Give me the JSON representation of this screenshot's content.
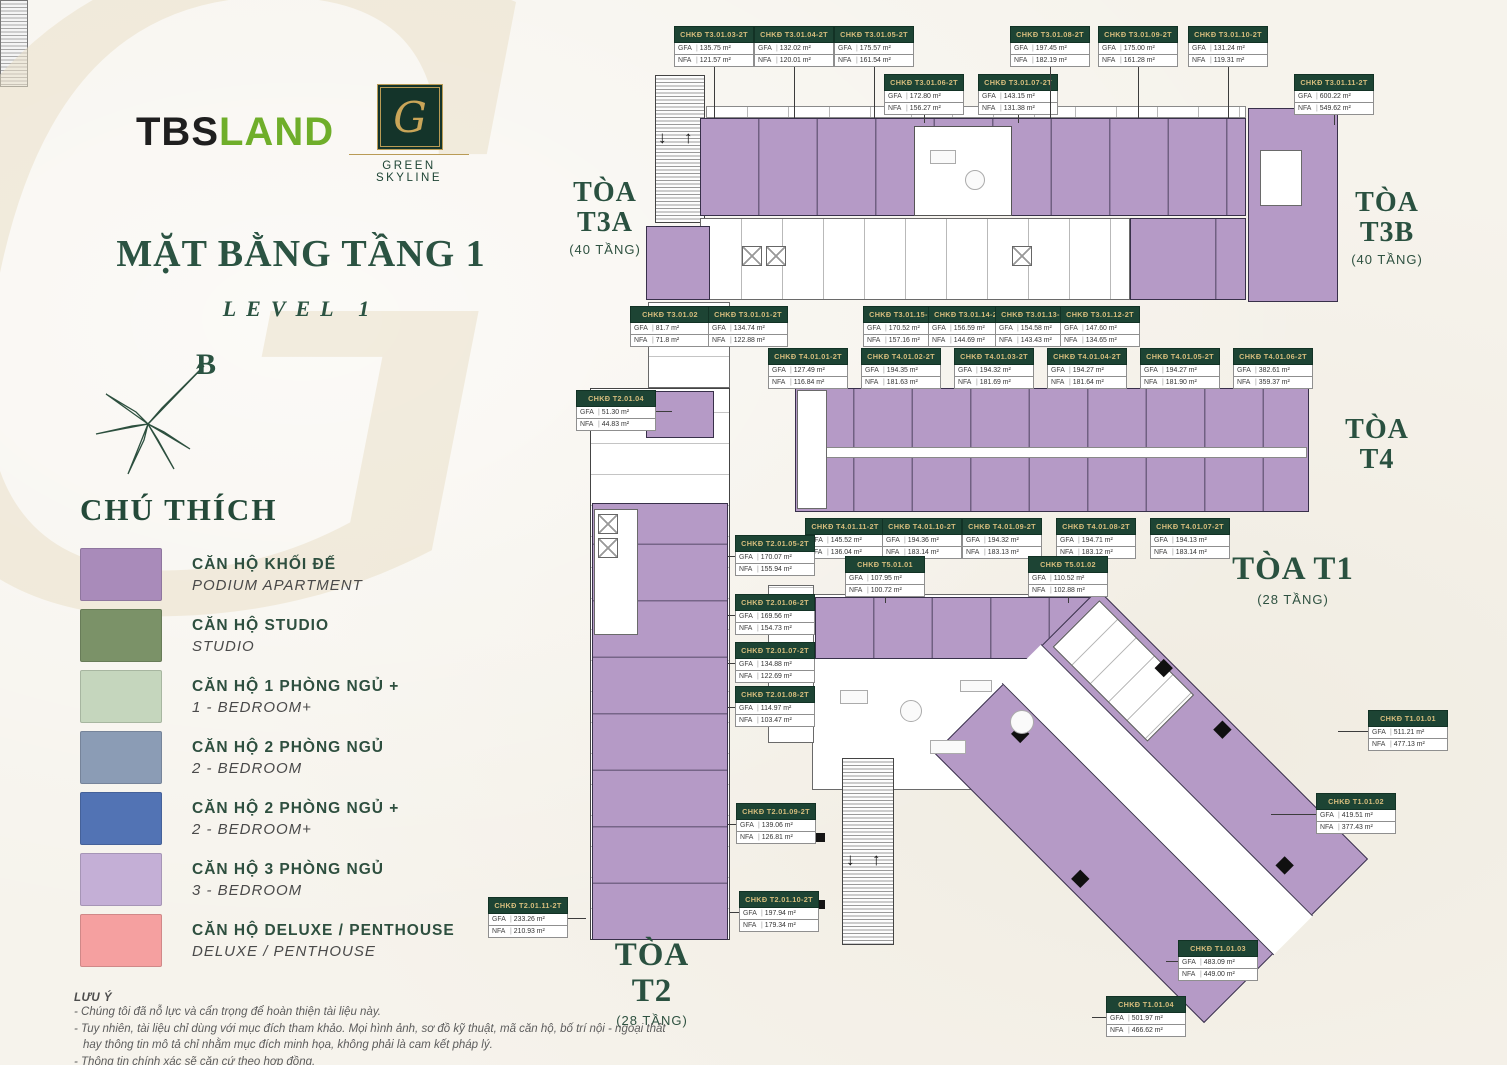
{
  "header": {
    "watermark": "G",
    "tbs_part1": "TBS",
    "tbs_part2": "LAND",
    "gs_monogram": "G",
    "gs_name": "GREEN SKYLINE",
    "title": "MẶT BẰNG TẦNG 1",
    "subtitle": "LEVEL 1",
    "compass": "B"
  },
  "icons": {
    "down_arrow": "↓",
    "up_arrow": "↑"
  },
  "labels": {
    "gfa": "GFA",
    "nfa": "NFA",
    "divider": "|"
  },
  "unit_label_prefix": "CHKĐ",
  "legend": {
    "title": "CHÚ THÍCH",
    "items": [
      {
        "vi": "CĂN HỘ KHỐI ĐẾ",
        "en": "PODIUM APARTMENT",
        "color": "#a98bba"
      },
      {
        "vi": "CĂN HỘ STUDIO",
        "en": "STUDIO",
        "color": "#7b9268"
      },
      {
        "vi": "CĂN HỘ 1 PHÒNG NGỦ +",
        "en": "1 - BEDROOM+",
        "color": "#c5d6bd"
      },
      {
        "vi": "CĂN HỘ 2 PHÒNG NGỦ",
        "en": "2 - BEDROOM",
        "color": "#8b9cb5"
      },
      {
        "vi": "CĂN HỘ 2 PHÒNG NGỦ +",
        "en": "2 - BEDROOM+",
        "color": "#5273b4"
      },
      {
        "vi": "CĂN HỘ 3 PHÒNG NGỦ",
        "en": "3 - BEDROOM",
        "color": "#c4afd6"
      },
      {
        "vi": "CĂN HỘ DELUXE / PENTHOUSE",
        "en": "DELUXE / PENTHOUSE",
        "color": "#f5a0a0"
      }
    ]
  },
  "buildings": [
    {
      "lines": [
        "TÒA",
        "T3A"
      ],
      "floors": "(40 TẦNG)",
      "x": 560,
      "y": 178,
      "w": 90,
      "size": 28
    },
    {
      "lines": [
        "TÒA",
        "T3B"
      ],
      "floors": "(40 TẦNG)",
      "x": 1342,
      "y": 188,
      "w": 90,
      "size": 28
    },
    {
      "lines": [
        "TÒA",
        "T4"
      ],
      "floors": "",
      "x": 1332,
      "y": 415,
      "w": 90,
      "size": 28
    },
    {
      "lines": [
        "TÒA T1"
      ],
      "floors": "(28 TẦNG)",
      "x": 1228,
      "y": 552,
      "w": 130,
      "size": 33
    },
    {
      "lines": [
        "TÒA T2"
      ],
      "floors": "(28 TẦNG)",
      "x": 592,
      "y": 938,
      "w": 120,
      "size": 33
    }
  ],
  "units": [
    {
      "id": "T3.01.03-2T",
      "gfa": "135.75 m²",
      "nfa": "121.57 m²",
      "x": 674,
      "y": 26,
      "ld": "down",
      "ll": 51
    },
    {
      "id": "T3.01.04-2T",
      "gfa": "132.02 m²",
      "nfa": "120.01 m²",
      "x": 754,
      "y": 26,
      "ld": "down",
      "ll": 51
    },
    {
      "id": "T3.01.05-2T",
      "gfa": "175.57 m²",
      "nfa": "161.54 m²",
      "x": 834,
      "y": 26,
      "ld": "down",
      "ll": 51
    },
    {
      "id": "T3.01.06-2T",
      "gfa": "172.80 m²",
      "nfa": "156.27 m²",
      "x": 884,
      "y": 74,
      "ld": "down",
      "ll": 8
    },
    {
      "id": "T3.01.07-2T",
      "gfa": "143.15 m²",
      "nfa": "131.38 m²",
      "x": 978,
      "y": 74,
      "ld": "down",
      "ll": 8
    },
    {
      "id": "T3.01.08-2T",
      "gfa": "197.45 m²",
      "nfa": "182.19 m²",
      "x": 1010,
      "y": 26,
      "ld": "down",
      "ll": 51
    },
    {
      "id": "T3.01.09-2T",
      "gfa": "175.00 m²",
      "nfa": "161.28 m²",
      "x": 1098,
      "y": 26,
      "ld": "down",
      "ll": 51
    },
    {
      "id": "T3.01.10-2T",
      "gfa": "131.24 m²",
      "nfa": "119.31 m²",
      "x": 1188,
      "y": 26,
      "ld": "down",
      "ll": 51
    },
    {
      "id": "T3.01.11-2T",
      "gfa": "600.22 m²",
      "nfa": "549.62 m²",
      "x": 1294,
      "y": 74,
      "ld": "down",
      "ll": 10
    },
    {
      "id": "T3.01.02",
      "gfa": "81.7 m²",
      "nfa": "71.8 m²",
      "x": 630,
      "y": 306
    },
    {
      "id": "T3.01.01-2T",
      "gfa": "134.74 m²",
      "nfa": "122.88 m²",
      "x": 708,
      "y": 306
    },
    {
      "id": "T3.01.15-2T",
      "gfa": "170.52 m²",
      "nfa": "157.16 m²",
      "x": 863,
      "y": 306
    },
    {
      "id": "T3.01.14-2T",
      "gfa": "156.59 m²",
      "nfa": "144.69 m²",
      "x": 928,
      "y": 306
    },
    {
      "id": "T3.01.13-2T",
      "gfa": "154.58 m²",
      "nfa": "143.43 m²",
      "x": 995,
      "y": 306
    },
    {
      "id": "T3.01.12-2T",
      "gfa": "147.60 m²",
      "nfa": "134.65 m²",
      "x": 1060,
      "y": 306
    },
    {
      "id": "T4.01.01-2T",
      "gfa": "127.49 m²",
      "nfa": "116.84 m²",
      "x": 768,
      "y": 348
    },
    {
      "id": "T4.01.02-2T",
      "gfa": "194.35 m²",
      "nfa": "181.63 m²",
      "x": 861,
      "y": 348
    },
    {
      "id": "T4.01.03-2T",
      "gfa": "194.32 m²",
      "nfa": "181.69 m²",
      "x": 954,
      "y": 348
    },
    {
      "id": "T4.01.04-2T",
      "gfa": "194.27 m²",
      "nfa": "181.64 m²",
      "x": 1047,
      "y": 348
    },
    {
      "id": "T4.01.05-2T",
      "gfa": "194.27 m²",
      "nfa": "181.90 m²",
      "x": 1140,
      "y": 348
    },
    {
      "id": "T4.01.06-2T",
      "gfa": "382.61 m²",
      "nfa": "359.37 m²",
      "x": 1233,
      "y": 348
    },
    {
      "id": "T4.01.11-2T",
      "gfa": "145.52 m²",
      "nfa": "136.04 m²",
      "x": 805,
      "y": 518
    },
    {
      "id": "T4.01.10-2T",
      "gfa": "194.36 m²",
      "nfa": "183.14 m²",
      "x": 882,
      "y": 518
    },
    {
      "id": "T4.01.09-2T",
      "gfa": "194.32 m²",
      "nfa": "183.13 m²",
      "x": 962,
      "y": 518
    },
    {
      "id": "T4.01.08-2T",
      "gfa": "194.71 m²",
      "nfa": "183.12 m²",
      "x": 1056,
      "y": 518
    },
    {
      "id": "T4.01.07-2T",
      "gfa": "194.13 m²",
      "nfa": "183.14 m²",
      "x": 1150,
      "y": 518
    },
    {
      "id": "T2.01.04",
      "gfa": "51.30 m²",
      "nfa": "44.83 m²",
      "x": 576,
      "y": 390,
      "ld": "right",
      "ll": 16
    },
    {
      "id": "T2.01.05-2T",
      "gfa": "170.07 m²",
      "nfa": "155.94 m²",
      "x": 735,
      "y": 535,
      "ld": "left",
      "ll": 7
    },
    {
      "id": "T2.01.06-2T",
      "gfa": "169.56 m²",
      "nfa": "154.73 m²",
      "x": 735,
      "y": 594,
      "ld": "left",
      "ll": 7
    },
    {
      "id": "T2.01.07-2T",
      "gfa": "134.88 m²",
      "nfa": "122.69 m²",
      "x": 735,
      "y": 642,
      "ld": "left",
      "ll": 7
    },
    {
      "id": "T2.01.08-2T",
      "gfa": "114.97 m²",
      "nfa": "103.47 m²",
      "x": 735,
      "y": 686,
      "ld": "left",
      "ll": 7
    },
    {
      "id": "T2.01.09-2T",
      "gfa": "139.06 m²",
      "nfa": "126.81 m²",
      "x": 736,
      "y": 803,
      "ld": "left",
      "ll": 8
    },
    {
      "id": "T2.01.10-2T",
      "gfa": "197.94 m²",
      "nfa": "179.34 m²",
      "x": 739,
      "y": 891,
      "ld": "left",
      "ll": 10
    },
    {
      "id": "T2.01.11-2T",
      "gfa": "233.26 m²",
      "nfa": "210.93 m²",
      "x": 488,
      "y": 897,
      "ld": "right",
      "ll": 18
    },
    {
      "id": "T5.01.01",
      "gfa": "107.95 m²",
      "nfa": "100.72 m²",
      "x": 845,
      "y": 556,
      "ld": "down",
      "ll": 6
    },
    {
      "id": "T5.01.02",
      "gfa": "110.52 m²",
      "nfa": "102.88 m²",
      "x": 1028,
      "y": 556,
      "ld": "down",
      "ll": 6
    },
    {
      "id": "T1.01.01",
      "gfa": "511.21 m²",
      "nfa": "477.13 m²",
      "x": 1368,
      "y": 710,
      "ld": "left",
      "ll": 30
    },
    {
      "id": "T1.01.02",
      "gfa": "419.51 m²",
      "nfa": "377.43 m²",
      "x": 1316,
      "y": 793,
      "ld": "left",
      "ll": 45
    },
    {
      "id": "T1.01.03",
      "gfa": "483.09 m²",
      "nfa": "449.00 m²",
      "x": 1178,
      "y": 940,
      "ld": "left",
      "ll": 12
    },
    {
      "id": "T1.01.04",
      "gfa": "501.97 m²",
      "nfa": "466.62 m²",
      "x": 1106,
      "y": 996,
      "ld": "left",
      "ll": 14
    }
  ],
  "notes": {
    "title": "LƯU Ý",
    "lines": [
      "- Chúng tôi đã nỗ lực và cẩn trọng để hoàn thiện tài liệu này.",
      "- Tuy nhiên, tài liệu chỉ dùng với mục đích tham khảo. Mọi hình ảnh, sơ đồ kỹ thuật, mã căn hộ, bố trí nội - ngoại thất",
      "hay thông tin mô tả chỉ nhằm mục đích minh họa, không phải là cam kết pháp lý.",
      "- Thông tin chính xác sẽ căn cứ theo hợp đồng."
    ]
  }
}
